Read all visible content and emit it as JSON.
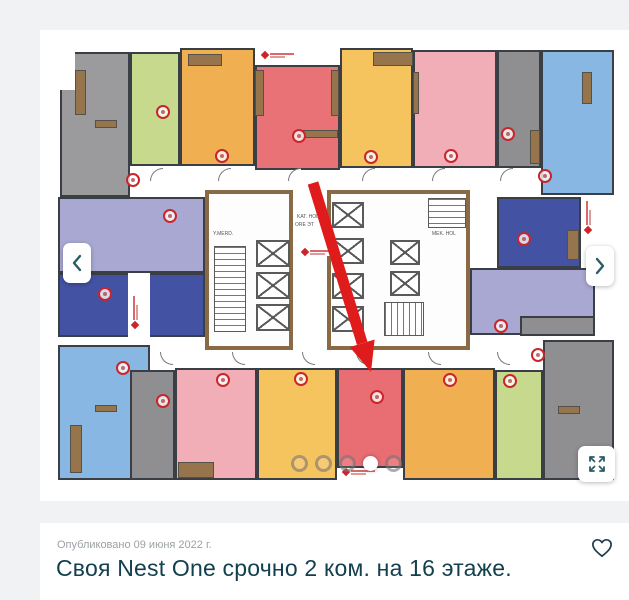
{
  "page": {
    "background": "#f1f2f4",
    "card_background": "#ffffff",
    "accent_teal": "#2a5d66"
  },
  "listing": {
    "published": "Опубликовано 09 июня 2022 г.",
    "title": "Своя Nest One срочно 2 ком. на 16 этаже."
  },
  "gallery": {
    "dots": {
      "count": 5,
      "active_index": 3
    }
  },
  "plan": {
    "wall_color": "#3a3f45",
    "accent_brown": "#96744c",
    "marker_color": "#c9252b",
    "arrow_color": "#e01b1b",
    "units": [
      {
        "name": "unit-gray-top-left",
        "color": "#9b9b9d",
        "x": 60,
        "y": 52,
        "w": 70,
        "h": 145
      },
      {
        "name": "unit-green-top",
        "color": "#c6d98c",
        "x": 130,
        "y": 52,
        "w": 50,
        "h": 114
      },
      {
        "name": "unit-orange-top",
        "color": "#f0b052",
        "x": 180,
        "y": 48,
        "w": 75,
        "h": 118
      },
      {
        "name": "unit-red-top",
        "color": "#e97277",
        "x": 255,
        "y": 65,
        "w": 85,
        "h": 105
      },
      {
        "name": "unit-yellow-top",
        "color": "#f5c45f",
        "x": 340,
        "y": 48,
        "w": 73,
        "h": 120
      },
      {
        "name": "unit-pink-top",
        "color": "#f2aeb6",
        "x": 413,
        "y": 50,
        "w": 84,
        "h": 118
      },
      {
        "name": "unit-gray-top-2",
        "color": "#8f8f92",
        "x": 497,
        "y": 50,
        "w": 44,
        "h": 118
      },
      {
        "name": "unit-blue-top-right",
        "color": "#88b7e3",
        "x": 541,
        "y": 50,
        "w": 73,
        "h": 145
      },
      {
        "name": "unit-lavender-left",
        "color": "#a9a8d3",
        "x": 58,
        "y": 197,
        "w": 147,
        "h": 76
      },
      {
        "name": "unit-darkblue-left",
        "color": "#4352a2",
        "x": 58,
        "y": 273,
        "w": 147,
        "h": 64
      },
      {
        "name": "unit-darkblue-right",
        "color": "#4352a2",
        "x": 497,
        "y": 197,
        "w": 84,
        "h": 71
      },
      {
        "name": "unit-lavender-right",
        "color": "#a9a8d3",
        "x": 470,
        "y": 268,
        "w": 125,
        "h": 67
      },
      {
        "name": "unit-gray-step-right",
        "color": "#8f8f92",
        "x": 520,
        "y": 316,
        "w": 75,
        "h": 20
      },
      {
        "name": "unit-blue-bottom-left",
        "color": "#88b7e3",
        "x": 58,
        "y": 345,
        "w": 92,
        "h": 135
      },
      {
        "name": "unit-gray-bottom-left",
        "color": "#8f8f92",
        "x": 130,
        "y": 370,
        "w": 45,
        "h": 110
      },
      {
        "name": "unit-pink-bottom",
        "color": "#f2aeb6",
        "x": 175,
        "y": 368,
        "w": 82,
        "h": 112
      },
      {
        "name": "unit-yellow-bottom",
        "color": "#f5c45f",
        "x": 257,
        "y": 368,
        "w": 80,
        "h": 112
      },
      {
        "name": "unit-red-target",
        "color": "#e96e74",
        "x": 337,
        "y": 368,
        "w": 66,
        "h": 100
      },
      {
        "name": "unit-orange-bottom",
        "color": "#f0b052",
        "x": 403,
        "y": 368,
        "w": 92,
        "h": 112
      },
      {
        "name": "unit-green-bottom",
        "color": "#c6d98c",
        "x": 495,
        "y": 370,
        "w": 48,
        "h": 110
      },
      {
        "name": "unit-gray-bottom-right",
        "color": "#8f8f92",
        "x": 543,
        "y": 340,
        "w": 71,
        "h": 140
      }
    ],
    "cores": [
      {
        "x": 205,
        "y": 190,
        "w": 88,
        "h": 160
      },
      {
        "x": 327,
        "y": 190,
        "w": 143,
        "h": 160
      }
    ],
    "white": [
      {
        "x": 58,
        "y": 48,
        "w": 17,
        "h": 42
      },
      {
        "x": 128,
        "y": 273,
        "w": 22,
        "h": 64
      }
    ],
    "furniture": [
      {
        "x": 75,
        "y": 70,
        "w": 11,
        "h": 45
      },
      {
        "x": 95,
        "y": 120,
        "w": 22,
        "h": 8
      },
      {
        "x": 188,
        "y": 54,
        "w": 34,
        "h": 12
      },
      {
        "x": 373,
        "y": 52,
        "w": 40,
        "h": 14
      },
      {
        "x": 255,
        "y": 70,
        "w": 9,
        "h": 46
      },
      {
        "x": 331,
        "y": 70,
        "w": 8,
        "h": 46
      },
      {
        "x": 300,
        "y": 130,
        "w": 38,
        "h": 8
      },
      {
        "x": 582,
        "y": 72,
        "w": 10,
        "h": 32
      },
      {
        "x": 567,
        "y": 230,
        "w": 12,
        "h": 30
      },
      {
        "x": 70,
        "y": 425,
        "w": 12,
        "h": 48
      },
      {
        "x": 95,
        "y": 405,
        "w": 22,
        "h": 7
      },
      {
        "x": 178,
        "y": 462,
        "w": 36,
        "h": 16
      },
      {
        "x": 558,
        "y": 406,
        "w": 22,
        "h": 8
      },
      {
        "x": 530,
        "y": 130,
        "w": 10,
        "h": 34
      },
      {
        "x": 413,
        "y": 72,
        "w": 6,
        "h": 42
      }
    ],
    "elevators": [
      {
        "x": 256,
        "y": 240,
        "w": 34,
        "h": 27
      },
      {
        "x": 256,
        "y": 272,
        "w": 34,
        "h": 27
      },
      {
        "x": 256,
        "y": 304,
        "w": 34,
        "h": 27
      },
      {
        "x": 332,
        "y": 202,
        "w": 32,
        "h": 26
      },
      {
        "x": 332,
        "y": 238,
        "w": 32,
        "h": 26
      },
      {
        "x": 332,
        "y": 273,
        "w": 32,
        "h": 26
      },
      {
        "x": 332,
        "y": 306,
        "w": 32,
        "h": 26
      },
      {
        "x": 390,
        "y": 240,
        "w": 30,
        "h": 25
      },
      {
        "x": 390,
        "y": 271,
        "w": 30,
        "h": 25
      }
    ],
    "stairs": [
      {
        "x": 214,
        "y": 246,
        "w": 32,
        "h": 86,
        "o": "h"
      },
      {
        "x": 384,
        "y": 302,
        "w": 40,
        "h": 34,
        "o": "v"
      },
      {
        "x": 428,
        "y": 198,
        "w": 38,
        "h": 30,
        "o": "h"
      }
    ],
    "doors": [
      {
        "x": 150,
        "y": 168,
        "c": "tl"
      },
      {
        "x": 218,
        "y": 168,
        "c": "tl"
      },
      {
        "x": 288,
        "y": 168,
        "c": "tl"
      },
      {
        "x": 362,
        "y": 168,
        "c": "tl"
      },
      {
        "x": 432,
        "y": 168,
        "c": "tl"
      },
      {
        "x": 500,
        "y": 168,
        "c": "tl"
      },
      {
        "x": 160,
        "y": 352,
        "c": "bl"
      },
      {
        "x": 232,
        "y": 352,
        "c": "bl"
      },
      {
        "x": 302,
        "y": 352,
        "c": "bl"
      },
      {
        "x": 356,
        "y": 352,
        "c": "bl"
      },
      {
        "x": 428,
        "y": 352,
        "c": "bl"
      },
      {
        "x": 497,
        "y": 352,
        "c": "bl"
      }
    ],
    "markers": [
      {
        "x": 163,
        "y": 112
      },
      {
        "x": 222,
        "y": 156
      },
      {
        "x": 133,
        "y": 180
      },
      {
        "x": 299,
        "y": 136
      },
      {
        "x": 371,
        "y": 157
      },
      {
        "x": 451,
        "y": 156
      },
      {
        "x": 508,
        "y": 134
      },
      {
        "x": 545,
        "y": 176
      },
      {
        "x": 170,
        "y": 216
      },
      {
        "x": 105,
        "y": 294
      },
      {
        "x": 524,
        "y": 239
      },
      {
        "x": 501,
        "y": 326
      },
      {
        "x": 123,
        "y": 368
      },
      {
        "x": 163,
        "y": 401
      },
      {
        "x": 223,
        "y": 380
      },
      {
        "x": 301,
        "y": 379
      },
      {
        "x": 377,
        "y": 397
      },
      {
        "x": 450,
        "y": 380
      },
      {
        "x": 510,
        "y": 381
      },
      {
        "x": 538,
        "y": 355
      }
    ],
    "logos": [
      {
        "x": 260,
        "y": 51
      },
      {
        "x": 341,
        "y": 468
      },
      {
        "x": 131,
        "y": 330,
        "v": true
      },
      {
        "x": 584,
        "y": 235,
        "v": true
      },
      {
        "x": 300,
        "y": 248
      }
    ],
    "labels": [
      {
        "x": 297,
        "y": 215,
        "t": "KAT. HOL"
      },
      {
        "x": 295,
        "y": 223,
        "t": "ORE ЭТ"
      },
      {
        "x": 432,
        "y": 232,
        "t": "MEK. HOL"
      },
      {
        "x": 213,
        "y": 232,
        "t": "Y.MERD."
      }
    ],
    "arrow": {
      "x1": 313,
      "y1": 183,
      "x2": 371,
      "y2": 372
    }
  }
}
